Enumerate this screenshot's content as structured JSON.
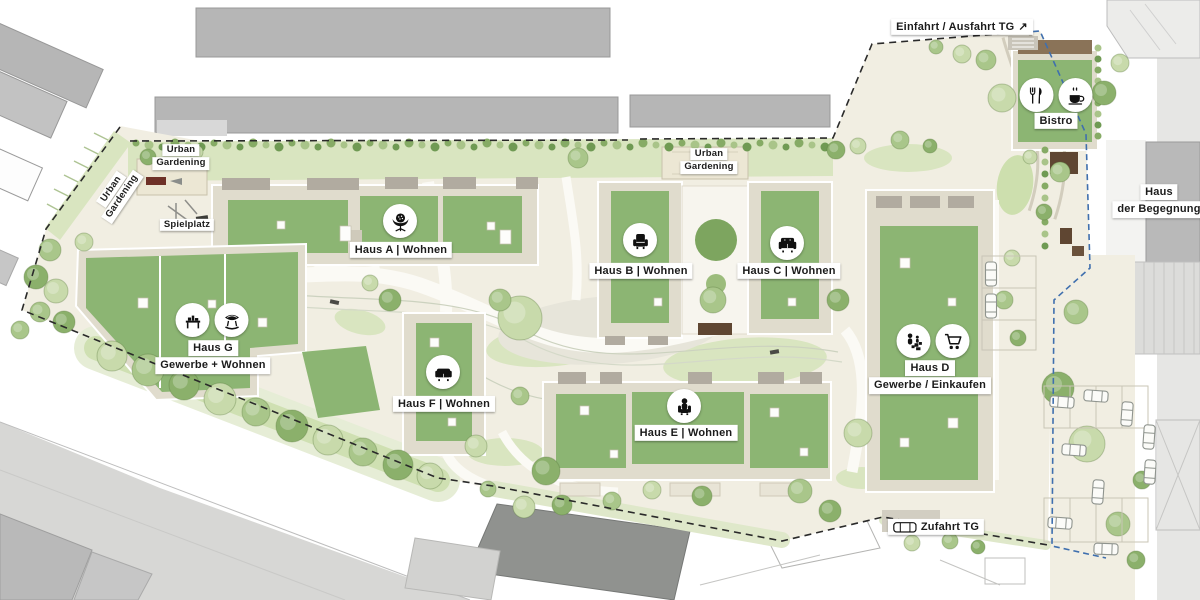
{
  "plan_title": "Wohnquartier Lageplan",
  "colors": {
    "label_bg": "#ffffff",
    "label_text": "#1b1b1b",
    "roof_green": "#8cb573",
    "lawn_green": "#d9e5c0",
    "site_cream": "#f1eee2",
    "boundary_blue": "#3f6fae",
    "boundary_dark": "#2a2a2a",
    "context_gray": "#b6b6b6",
    "planter_brown": "#5f4632",
    "icon_fg": "#111111"
  },
  "labels": [
    {
      "id": "urban-gardening-left",
      "lines": [
        "Urban",
        "Gardening"
      ],
      "x": 117,
      "y": 193,
      "rotate": -56,
      "size": "small"
    },
    {
      "id": "urban-gardening-top",
      "lines": [
        "Urban",
        "Gardening"
      ],
      "x": 181,
      "y": 157,
      "size": "small"
    },
    {
      "id": "spielplatz",
      "lines": [
        "Spielplatz"
      ],
      "x": 187,
      "y": 225,
      "size": "small"
    },
    {
      "id": "urban-gardening-right",
      "lines": [
        "Urban",
        "Gardening"
      ],
      "x": 709,
      "y": 161,
      "size": "small"
    },
    {
      "id": "haus-a",
      "lines": [
        "Haus A | Wohnen"
      ],
      "x": 401,
      "y": 250,
      "icons": [
        "ball-chair"
      ],
      "icon_x": 400,
      "icon_y": 221
    },
    {
      "id": "haus-b",
      "lines": [
        "Haus B | Wohnen"
      ],
      "x": 641,
      "y": 271,
      "icons": [
        "armchair"
      ],
      "icon_x": 640,
      "icon_y": 240
    },
    {
      "id": "haus-c",
      "lines": [
        "Haus C | Wohnen"
      ],
      "x": 789,
      "y": 271,
      "icons": [
        "sofa"
      ],
      "icon_x": 787,
      "icon_y": 243
    },
    {
      "id": "haus-d",
      "lines": [
        "Haus D",
        "Gewerbe / Einkaufen"
      ],
      "x": 930,
      "y": 377,
      "icons": [
        "family-shopping",
        "shopping-cart"
      ],
      "icon_x": 933,
      "icon_y": 341
    },
    {
      "id": "haus-e",
      "lines": [
        "Haus E | Wohnen"
      ],
      "x": 686,
      "y": 433,
      "icons": [
        "person-armchair"
      ],
      "icon_x": 684,
      "icon_y": 406
    },
    {
      "id": "haus-f",
      "lines": [
        "Haus F | Wohnen"
      ],
      "x": 444,
      "y": 404,
      "icons": [
        "sofa-low"
      ],
      "icon_x": 443,
      "icon_y": 372
    },
    {
      "id": "haus-g",
      "lines": [
        "Haus G",
        "Gewerbe + Wohnen"
      ],
      "x": 213,
      "y": 357,
      "icons": [
        "workbench",
        "lounge-chair"
      ],
      "icon_x": 212,
      "icon_y": 320
    },
    {
      "id": "bistro",
      "lines": [
        "Bistro"
      ],
      "x": 1056,
      "y": 121,
      "icons": [
        "fork-knife",
        "coffee-cup"
      ],
      "icon_x": 1056,
      "icon_y": 95
    },
    {
      "id": "einfahrt-ausfahrt-tg",
      "lines": [
        "Einfahrt / Ausfahrt TG"
      ],
      "arrow": "↗",
      "x": 962,
      "y": 27
    },
    {
      "id": "zufahrt-tg",
      "lines": [
        "Zufahrt TG"
      ],
      "inline_icon": "car-top",
      "x": 936,
      "y": 527
    },
    {
      "id": "haus-der-begegnung",
      "lines": [
        "Haus",
        "der Begegnung"
      ],
      "x": 1159,
      "y": 201
    }
  ]
}
